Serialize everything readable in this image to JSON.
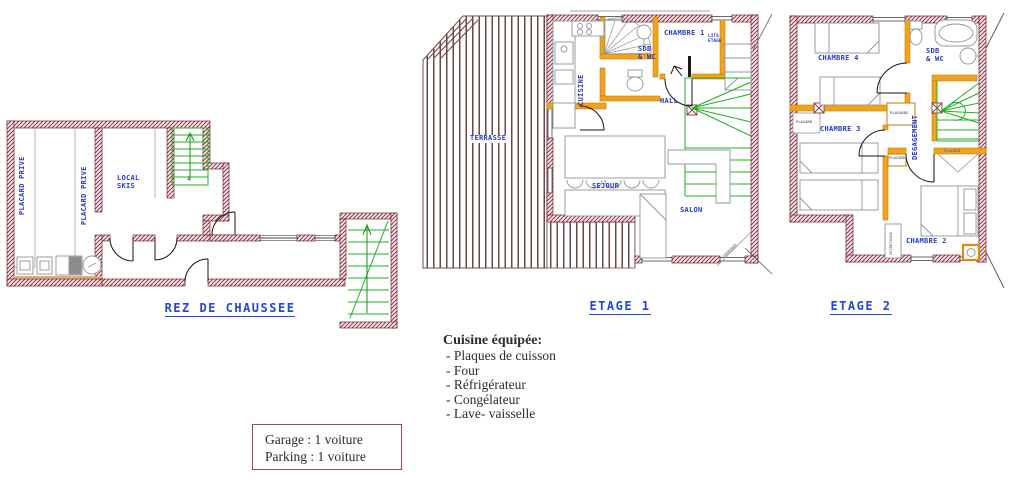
{
  "colors": {
    "wall": "#8a3245",
    "partition": "#f2a31d",
    "stairs": "#21b021",
    "label_blue": "#2438c8",
    "note_border": "#9c4666"
  },
  "plans": {
    "rdc": {
      "title": "REZ DE CHAUSSEE",
      "rooms": {
        "placard1": "PLACARD PRIVE",
        "placard2": "PLACARD PRIVE",
        "local_line1": "LOCAL",
        "local_line2": "SKIS",
        "stair_number": "1"
      }
    },
    "etage1": {
      "title": "ETAGE 1",
      "rooms": {
        "terrasse": "TERRASSE",
        "cuisine": "CUISINE",
        "sdb_line1": "SDB",
        "sdb_line2": "& WC",
        "chambre1": "CHAMBRE 1",
        "lits_line1": "LITS",
        "lits_line2": "ETAGE",
        "hall": "HALL",
        "sejour": "SEJOUR",
        "salon": "SALON",
        "cheminee": "CHEMINEE"
      }
    },
    "etage2": {
      "title": "ETAGE 2",
      "rooms": {
        "chambre4": "CHAMBRE 4",
        "chambre3": "CHAMBRE 3",
        "chambre2": "CHAMBRE 2",
        "sdb_line1": "SDB",
        "sdb_line2": "& WC",
        "degagement": "DEGAGEMENT",
        "placard_left": "PLACARD",
        "placards_mid": "PLACARDS",
        "placard_right": "PLACARD",
        "placard_small": "PLACARD",
        "secretaire": "SECRETAIRE"
      }
    }
  },
  "kitchen_note": {
    "heading": "Cuisine équipée:",
    "items": [
      "- Plaques de cuisson",
      "- Four",
      "- Réfrigérateur",
      "- Congélateur",
      "- Lave- vaisselle"
    ]
  },
  "garage_note": {
    "line1": "Garage : 1 voiture",
    "line2": "Parking : 1 voiture"
  }
}
